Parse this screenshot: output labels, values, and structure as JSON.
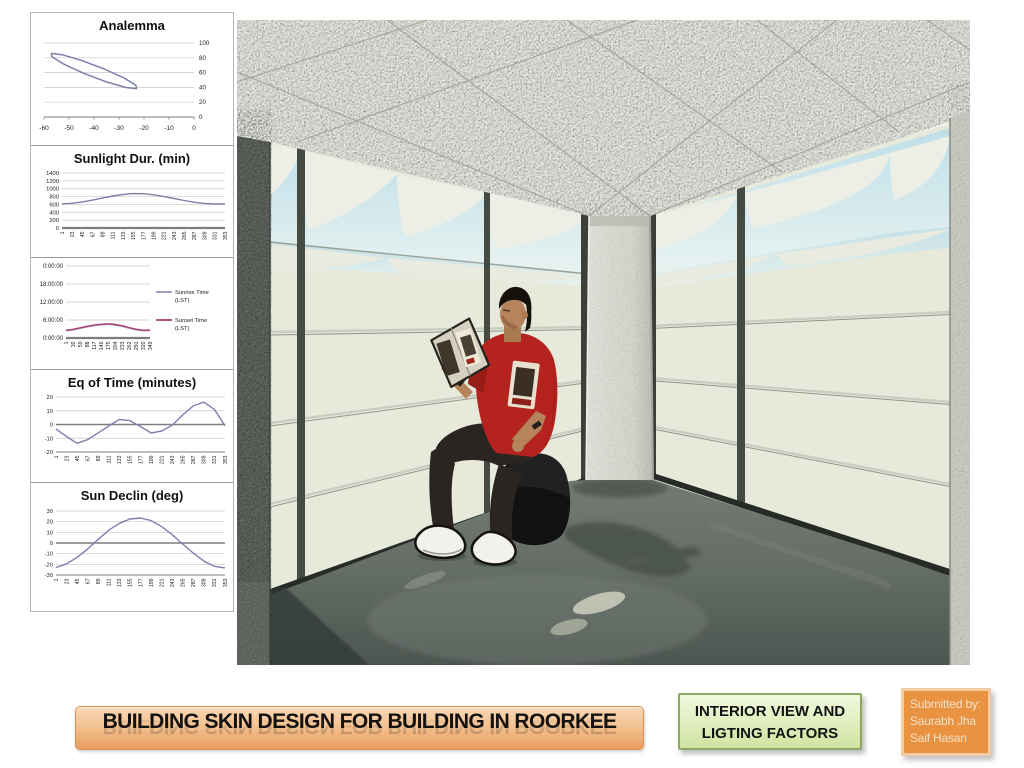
{
  "slide": {
    "title_banner": "BUILDING SKIN DESIGN FOR BUILDING IN ROORKEE",
    "caption": {
      "line1": "INTERIOR VIEW AND",
      "line2": "LIGTING FACTORS"
    },
    "submitted": {
      "line1": "Submitted by:",
      "line2": "Saurabh Jha",
      "line3": "Saif Hasan"
    },
    "accent_colors": {
      "banner_orange": "#F3C291",
      "caption_green": "#D8E9AC",
      "submitted_orange": "#E9923F",
      "chart_line_purple": "#7C80AB",
      "sunset_pink": "#B04070",
      "sunrise_gray": "#9495B8"
    }
  },
  "chart_data": [
    {
      "type": "scatter",
      "title": "Analemma",
      "x": [
        -57.1,
        -56.8,
        -52.1,
        -44.1,
        -35.0,
        -27.3,
        -23.0,
        -23.2,
        -27.9,
        -35.9,
        -45.0,
        -52.7,
        -57.1
      ],
      "y": [
        86.0,
        81.3,
        71.5,
        59.1,
        47.5,
        39.8,
        38.1,
        42.7,
        52.5,
        64.9,
        76.5,
        84.2,
        86.0
      ],
      "xlim": [
        -60,
        0
      ],
      "ylim": [
        0,
        100
      ],
      "xticks": [
        -60,
        -50,
        -40,
        -30,
        -20,
        -10,
        0
      ],
      "yticks": [
        0,
        20,
        40,
        60,
        80,
        100
      ],
      "ytick_side": "right",
      "color": "#7c80ab",
      "grid": true
    },
    {
      "type": "line",
      "title": "Sunlight Dur. (min)",
      "categories": [
        1,
        23,
        45,
        67,
        89,
        111,
        133,
        155,
        177,
        199,
        221,
        243,
        265,
        287,
        309,
        331,
        353
      ],
      "values": [
        615,
        630,
        665,
        710,
        765,
        815,
        855,
        875,
        872,
        845,
        800,
        750,
        700,
        655,
        625,
        610,
        612
      ],
      "ylim": [
        0,
        1400
      ],
      "yticks": [
        0,
        200,
        400,
        600,
        800,
        1000,
        1200,
        1400
      ],
      "color": "#7c80ab",
      "grid": true
    },
    {
      "type": "line",
      "title": "",
      "categories": [
        1,
        30,
        59,
        88,
        117,
        146,
        175,
        204,
        233,
        262,
        291,
        320,
        349
      ],
      "series": [
        {
          "name": "Sunrise Time (LST)",
          "color": "#9495b8",
          "values": [
            2.45,
            2.7,
            3.2,
            3.7,
            4.1,
            4.4,
            4.55,
            4.35,
            3.9,
            3.3,
            2.75,
            2.45,
            2.5
          ]
        },
        {
          "name": "Sunset Time (LST)",
          "color": "#b04070",
          "values": [
            2.6,
            2.9,
            3.4,
            3.9,
            4.3,
            4.6,
            4.75,
            4.55,
            4.1,
            3.5,
            2.95,
            2.6,
            2.65
          ]
        }
      ],
      "ylim": [
        0,
        24
      ],
      "yticks": [
        0,
        6,
        12,
        18,
        24
      ],
      "ytick_labels": [
        "0:00:00",
        "6:00:00",
        "12:00:00",
        "18:00:00",
        "0:00:00"
      ],
      "legend_position": "right",
      "grid": true
    },
    {
      "type": "line",
      "title": "Eq of Time (minutes)",
      "categories": [
        1,
        23,
        45,
        67,
        89,
        111,
        133,
        155,
        177,
        199,
        221,
        243,
        265,
        287,
        309,
        331,
        353
      ],
      "values": [
        -3.2,
        -8.8,
        -13.7,
        -11,
        -6,
        -1,
        3.6,
        2.8,
        -1.5,
        -6.2,
        -4.8,
        -0.5,
        7,
        13.5,
        16.3,
        11,
        -1
      ],
      "ylim": [
        -20,
        20
      ],
      "yticks": [
        -20,
        -10,
        0,
        10,
        20
      ],
      "color": "#7c80ab",
      "grid": true
    },
    {
      "type": "line",
      "title": "Sun Declin (deg)",
      "categories": [
        1,
        23,
        45,
        67,
        89,
        111,
        133,
        155,
        177,
        199,
        221,
        243,
        265,
        287,
        309,
        331,
        353
      ],
      "values": [
        -23,
        -19.5,
        -13.5,
        -5.5,
        3.5,
        12,
        18.5,
        22.5,
        23.4,
        21,
        15.5,
        7.8,
        -1,
        -9.5,
        -17,
        -21.8,
        -23.3
      ],
      "ylim": [
        -30,
        30
      ],
      "yticks": [
        -30,
        -20,
        -10,
        0,
        10,
        20,
        30
      ],
      "color": "#7c80ab",
      "grid": true
    }
  ]
}
